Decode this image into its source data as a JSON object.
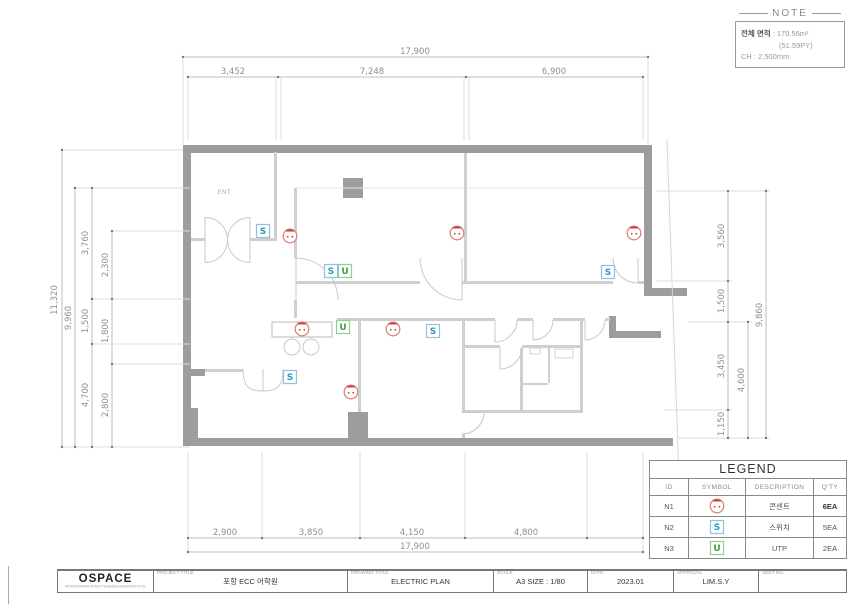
{
  "plan": {
    "ent": "ENT"
  },
  "symbols": {
    "switch_letter": "S",
    "utp_letter": "U"
  },
  "note": {
    "title": "NOTE",
    "line1_label": "전체 면적",
    "line1_value": ": 170.56m²",
    "line2": "(51.59PY)",
    "line3": "CH :  2,500mm"
  },
  "dims": {
    "top": {
      "overall": "17,900",
      "segments": [
        "3,452",
        "7,248",
        "6,900"
      ]
    },
    "bottom": {
      "overall": "17,900",
      "segments": [
        "2,900",
        "3,850",
        "4,150",
        "4,800"
      ]
    },
    "left": {
      "outer": "11,320",
      "inner": "9,960",
      "segments": [
        "3,760",
        "1,500",
        "4,700"
      ],
      "sub_segments": [
        "2,300",
        "1,800",
        "2,800"
      ]
    },
    "right": {
      "segments": [
        "3,560",
        "1,500",
        "3,450",
        "1,150"
      ],
      "mid": "4,600",
      "outer": "9,860"
    }
  },
  "legend": {
    "title": "LEGEND",
    "headers": [
      "ID",
      "SYMBOL",
      "DESCRIPTION",
      "Q'TY"
    ],
    "rows": [
      {
        "id": "N1",
        "symbol_icon": "outlet-circle-icon",
        "description": "콘센트",
        "qty": "6EA"
      },
      {
        "id": "N2",
        "symbol_icon": "switch-box-icon",
        "description": "스위치",
        "qty": "5EA"
      },
      {
        "id": "N3",
        "symbol_icon": "utp-box-icon",
        "description": "UTP",
        "qty": "2EA"
      }
    ]
  },
  "titleblock": {
    "company": "OSPACE",
    "company_sub": "INTERIOR/ARCHITECTURE/DESIGN/INSTITUTE",
    "project_label": "PROJECT TITLE",
    "project_value": "포항 ECC 어학원",
    "drawing_label": "DRAWING TITLE",
    "drawing_value": "ELECTRIC PLAN",
    "scale_label": "SCALE",
    "scale_value": "A3 SIZE : 1/80",
    "date_label": "DATE",
    "date_value": "2023.01",
    "approval_label": "APPROVAL",
    "approval_value": "LIM.S.Y",
    "sheet_label": "SEET NO.",
    "sheet_value": ""
  },
  "colors": {
    "wall_gray": "#9d9d9d",
    "outlet_red": "#c44536",
    "switch_blue": "#2e9bc4",
    "utp_green": "#3f9e3f"
  }
}
